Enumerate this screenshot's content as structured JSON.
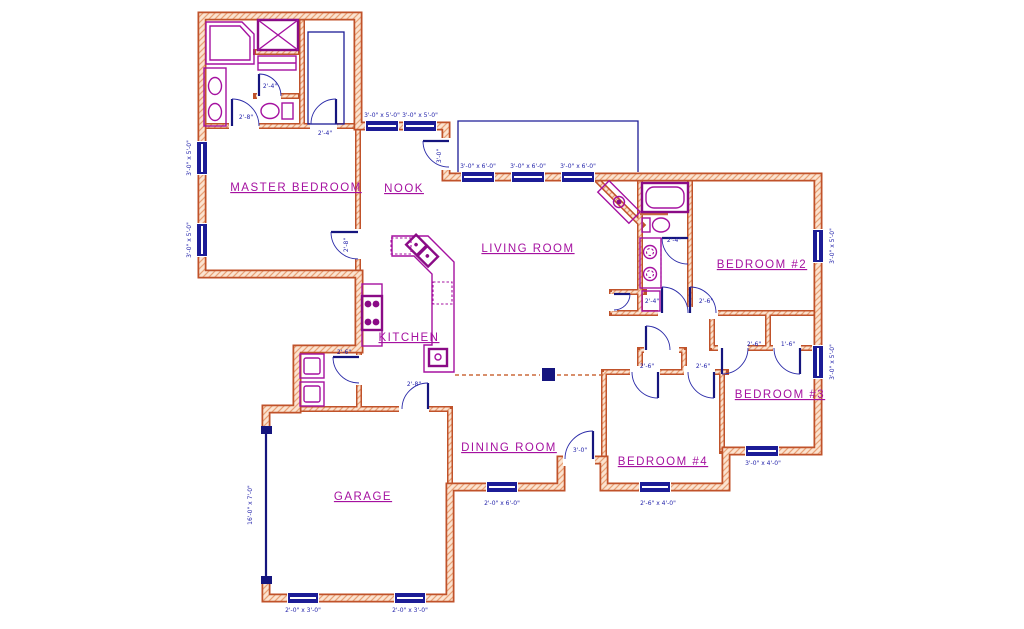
{
  "title": "Residential floor plan drawing",
  "colors": {
    "wall": "#c0522a",
    "wall_hatch": "#e8a075",
    "wall_fill": "#fbe3d0",
    "fixture": "#a511a0",
    "fixture_dark": "#8a0b86",
    "door": "#15157e",
    "window": "#1c1c96",
    "dim_text": "#2222aa",
    "label_text": "#a511a0",
    "background": "#ffffff"
  },
  "rooms": [
    {
      "id": "master-bedroom",
      "label": "MASTER BEDROOM",
      "x": 296,
      "y": 191
    },
    {
      "id": "nook",
      "label": "NOOK",
      "x": 404,
      "y": 192
    },
    {
      "id": "living-room",
      "label": "LIVING ROOM",
      "x": 528,
      "y": 252
    },
    {
      "id": "kitchen",
      "label": "KITCHEN",
      "x": 409,
      "y": 341
    },
    {
      "id": "bedroom-2",
      "label": "BEDROOM #2",
      "x": 762,
      "y": 268
    },
    {
      "id": "bedroom-3",
      "label": "BEDROOM #3",
      "x": 780,
      "y": 398
    },
    {
      "id": "bedroom-4",
      "label": "BEDROOM #4",
      "x": 663,
      "y": 465
    },
    {
      "id": "dining-room",
      "label": "DINING ROOM",
      "x": 509,
      "y": 451
    },
    {
      "id": "garage",
      "label": "GARAGE",
      "x": 363,
      "y": 500
    }
  ],
  "window_dims": [
    {
      "t": "3'-0\" x 5'-0\"",
      "x": 382,
      "y": 117
    },
    {
      "t": "3'-0\" x 5'-0\"",
      "x": 420,
      "y": 117
    },
    {
      "t": "3'-0\" x 6'-0\"",
      "x": 478,
      "y": 168
    },
    {
      "t": "3'-0\" x 6'-0\"",
      "x": 528,
      "y": 168
    },
    {
      "t": "3'-0\" x 6'-0\"",
      "x": 578,
      "y": 168
    },
    {
      "t": "3'-0\" x 5'-0\"",
      "x": 191,
      "y": 158,
      "r": -90
    },
    {
      "t": "3'-0\" x 5'-0\"",
      "x": 191,
      "y": 240,
      "r": -90
    },
    {
      "t": "3'-0\" x 5'-0\"",
      "x": 834,
      "y": 246,
      "r": -90
    },
    {
      "t": "3'-0\" x 5'-0\"",
      "x": 834,
      "y": 362,
      "r": -90
    },
    {
      "t": "3'-0\" x 4'-0\"",
      "x": 763,
      "y": 465
    },
    {
      "t": "2'-6\" x 4'-0\"",
      "x": 658,
      "y": 505
    },
    {
      "t": "2'-0\" x 6'-0\"",
      "x": 502,
      "y": 505
    },
    {
      "t": "2'-0\" x 3'-0\"",
      "x": 303,
      "y": 612
    },
    {
      "t": "2'-0\" x 3'-0\"",
      "x": 410,
      "y": 612
    },
    {
      "t": "16'-0\" x 7'-0\"",
      "x": 252,
      "y": 505,
      "r": -90
    }
  ],
  "door_dims": [
    {
      "t": "2'-8\"",
      "x": 246,
      "y": 119
    },
    {
      "t": "2'-4\"",
      "x": 270,
      "y": 88
    },
    {
      "t": "2'-4\"",
      "x": 325,
      "y": 135
    },
    {
      "t": "2'-8\"",
      "x": 348,
      "y": 245,
      "r": -90
    },
    {
      "t": "3'-0\"",
      "x": 441,
      "y": 156,
      "r": -90
    },
    {
      "t": "2'-4\"",
      "x": 674,
      "y": 242
    },
    {
      "t": "2'-4\"",
      "x": 652,
      "y": 303
    },
    {
      "t": "2'-6\"",
      "x": 706,
      "y": 303
    },
    {
      "t": "2'-6\"",
      "x": 647,
      "y": 368
    },
    {
      "t": "2'-6\"",
      "x": 703,
      "y": 368
    },
    {
      "t": "2'-6\"",
      "x": 754,
      "y": 346
    },
    {
      "t": "1'-6\"",
      "x": 788,
      "y": 346
    },
    {
      "t": "3'-0\"",
      "x": 580,
      "y": 452
    },
    {
      "t": "2'-6\"",
      "x": 344,
      "y": 354
    },
    {
      "t": "2'-8\"",
      "x": 414,
      "y": 386
    }
  ]
}
